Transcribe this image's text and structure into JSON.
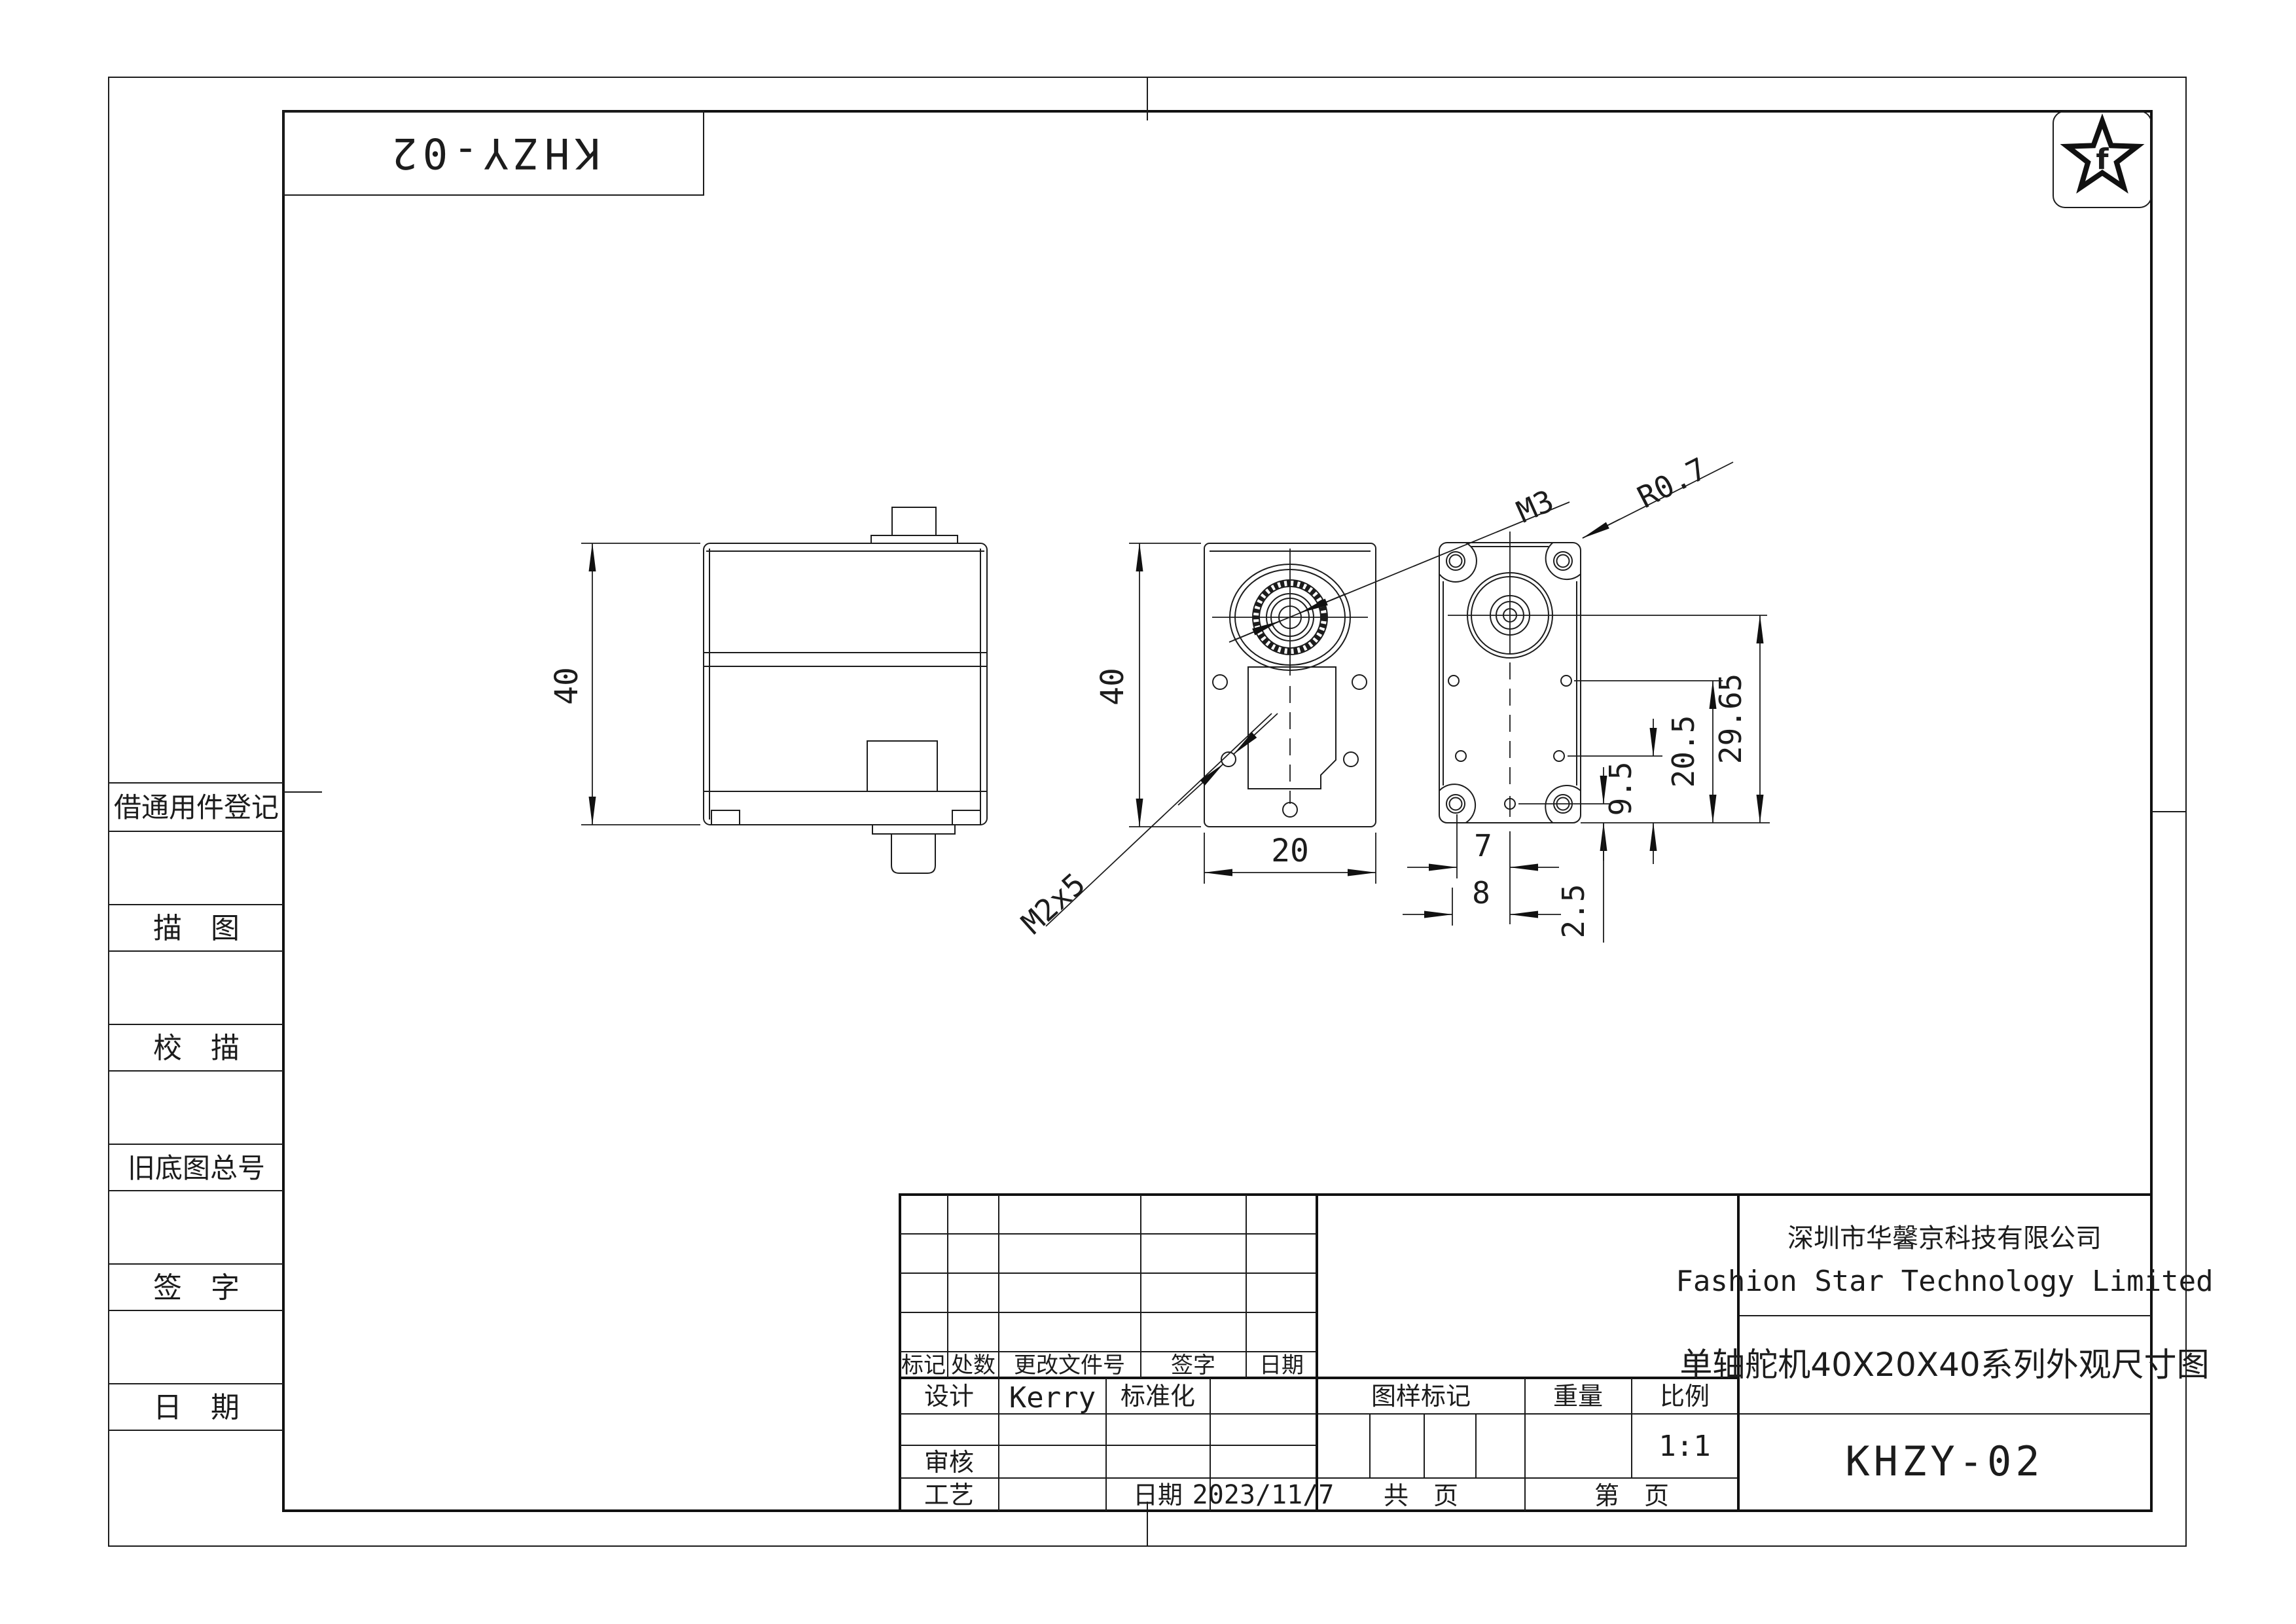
{
  "page": {
    "part_number_top": "KHZY-02",
    "logo_letter": "f"
  },
  "sidebar": {
    "rows": [
      "借通用件登记",
      "描　图",
      "校　描",
      "旧底图总号",
      "签　字",
      "日　期"
    ]
  },
  "views": {
    "dim_40_left": "40",
    "dim_40_mid": "40",
    "dim_20": "20",
    "label_m3": "M3",
    "label_m2x5": "M2x5",
    "label_r07": "R0.7",
    "dim_2965": "29.65",
    "dim_205": "20.5",
    "dim_95": "9.5",
    "dim_7": "7",
    "dim_8": "8",
    "dim_25": "2.5"
  },
  "title_block": {
    "rev_headers": [
      "标记",
      "处数",
      "更改文件号",
      "签字",
      "日期"
    ],
    "design_label": "设计",
    "designer": "Kerry",
    "standard_label": "标准化",
    "audit_label": "审核",
    "process_label": "工艺",
    "date_label": "日期",
    "date_value": "2023/11/7",
    "stamp_label": "图样标记",
    "weight_label": "重量",
    "scale_label": "比例",
    "scale_value": "1:1",
    "pages_total": "共　页",
    "pages_current": "第　页",
    "company_cn": "深圳市华馨京科技有限公司",
    "company_en": "Fashion Star Technology Limited",
    "drawing_title": "单轴舵机40X20X40系列外观尺寸图",
    "part_number": "KHZY-02"
  }
}
